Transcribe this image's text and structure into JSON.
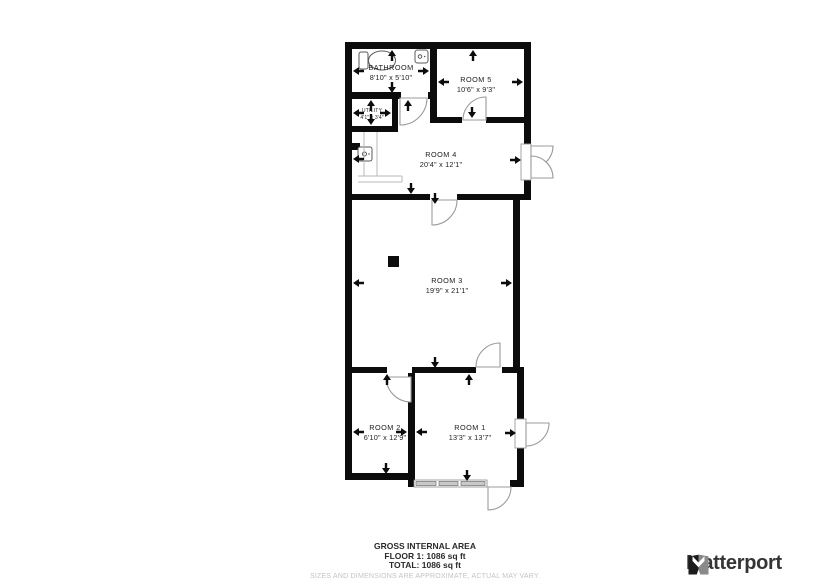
{
  "plan": {
    "rooms": {
      "bathroom": {
        "name": "BATHROOM",
        "dims": "8'10\" x 5'10\""
      },
      "room5": {
        "name": "ROOM 5",
        "dims": "10'6\" x 9'3\""
      },
      "utility": {
        "name": "UTILITY",
        "dims": "4'1\" x 3'4\""
      },
      "room4": {
        "name": "ROOM 4",
        "dims": "20'4\" x 12'1\""
      },
      "room3": {
        "name": "ROOM 3",
        "dims": "19'9\" x 21'1\""
      },
      "room2": {
        "name": "ROOM 2",
        "dims": "6'10\" x 12'9\""
      },
      "room1": {
        "name": "ROOM 1",
        "dims": "13'3\" x 13'7\""
      }
    },
    "icons": [
      "toilet-icon",
      "sink-icon",
      "appliance-icon"
    ],
    "colors": {
      "wall": "#0c0c0c",
      "door_line": "#9b9b9b",
      "window_fill": "#c9c9c9",
      "fixture_line": "#5a5a5a",
      "counter_line": "#b8b8b8"
    }
  },
  "footer": {
    "title": "GROSS INTERNAL AREA",
    "floor_line": "FLOOR 1: 1086 sq ft",
    "total_line": "TOTAL: 1086 sq ft",
    "disclaimer": "SIZES AND DIMENSIONS ARE APPROXIMATE, ACTUAL MAY VARY."
  },
  "branding": {
    "logo_text": "Matterport",
    "logo_colors": {
      "dark": "#1b1b1b",
      "gray": "#8a8a8a"
    }
  }
}
